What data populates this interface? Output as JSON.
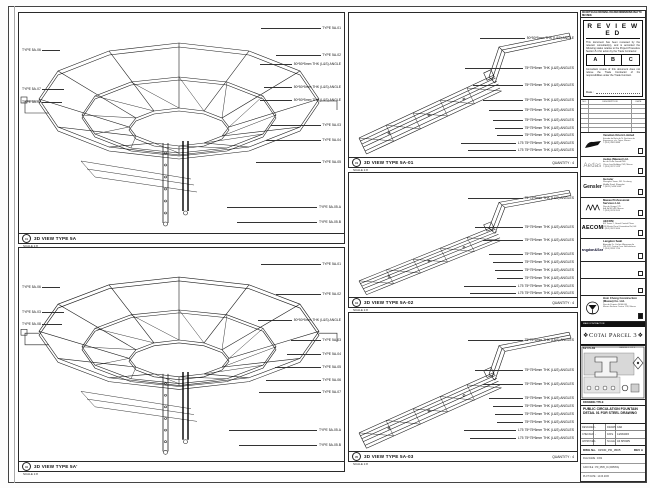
{
  "notice_line": "DO NOT SCALE DRAWING. FIGURED DIMENSIONS ONLY TO BE USED.",
  "stamp": {
    "title": "R E V I E W E D",
    "para1": "This document has been reviewed by the relevant consultant(s), and is accorded the following status relative to the Project Procedure Section 5.4 for action by the Trade Contractor.",
    "options": [
      "A",
      "B",
      "C"
    ],
    "para2": "Consultant review of this document does not relieve the Trade Contractor of his responsibilities under the Trade Contract.",
    "date_label": "Date :"
  },
  "revision_table": {
    "headers": [
      "NO.",
      "DESCRIPTION",
      "DATE"
    ]
  },
  "consultants": [
    {
      "logo_icon": "venetian-flag-logo",
      "logo_text": "Venetian",
      "name": "Venetian Orient Limited",
      "address": "Estrada da Baía de N. Senhora da\nEsperança, s/n, Taipa, Macau\nT (853) 2882 8888",
      "checked": false
    },
    {
      "logo_icon": "aedas-wordmark-logo",
      "logo_text": "Aedas",
      "name": "Aedas (Macau) Ltd.",
      "address": "Av. da Praia Grande 409\nChina Law Building 21/F, Macau\nT (853) 2871 5123",
      "checked": false
    },
    {
      "logo_icon": "gensler-wordmark-logo",
      "logo_text": "Gensler",
      "name": "Gensler",
      "address": "Shanghai Tower, 501 Yincheng\nMiddle Road, Shanghai\nT (8621) 5466 5000",
      "checked": false
    },
    {
      "logo_icon": "mps-logo",
      "logo_text": "⋀⋀⋀",
      "name": "Macau Professional\nServices Ltd.",
      "address": "Rua de Xangai 175\nEdf. ACM 14/F, Macau\nT (853) 2878 9915",
      "checked": false
    },
    {
      "logo_icon": "aecom-wordmark-logo",
      "logo_text": "AECOM",
      "name": "AECOM",
      "address": "8/F Tower 2, Grand Central Plaza\n138 Shatin Rural Committee Rd, HK\nT (852) 3922 9000",
      "checked": false
    },
    {
      "logo_icon": "langdon-seah-wordmark-logo",
      "logo_text": "Langdon&Seah",
      "name": "Langdon Seah",
      "address": "Alameda Dr. Carlos d'Assumpção\n181-187, Centro Com. Brilhantismo\nT (853) 2833 1710",
      "checked": false
    },
    {
      "logo_text": "",
      "name": "",
      "address": "",
      "checked": false
    },
    {
      "logo_text": "",
      "name": "",
      "address": "",
      "checked": false
    },
    {
      "logo_icon": "hsin-chong-circle-logo",
      "logo_text": "",
      "name": "Hsin Chong Construction\n(Macau) Co. Ltd.",
      "address": "Rua de Pequim 202A-246\nMacau Finance Centre 17/F, Macau",
      "checked": true
    }
  ],
  "main_contractor_label": "MAIN CONTRACTOR",
  "banner": {
    "project": "Cotai Parcel 3",
    "ornament": "❖"
  },
  "keyplan": {
    "caption": "KEY PLAN",
    "parcel": "PARCEL 1 OF 3"
  },
  "title_block": {
    "drawing_title_label": "DRAWING TITLE",
    "title_text": "PUBLIC CIRCULATION FOUNTAIN DETAIL 01 FOR STEEL DRAWING",
    "fields": {
      "rows": [
        {
          "l1": "DESIGNED",
          "v1": "-",
          "l2": "DRAWN",
          "v2": "CAD"
        },
        {
          "l1": "CHECKED",
          "v1": "-",
          "l2": "DATE",
          "v2": "14/03/2015"
        },
        {
          "l1": "APPROVED",
          "v1": "-",
          "l2": "SCALE",
          "v2": "AS SHOWN"
        }
      ]
    },
    "dwg": {
      "label": "DWG No.",
      "value": "01530_PD_0505",
      "rev_label": "REV",
      "rev": "A"
    },
    "footer_rows": [
      "FILE NAME : 0152",
      "CAD FILE : PD_0505_01 (R0505A)",
      "PLOT DATE : 14.03.2015"
    ]
  },
  "panels": {
    "p1": {
      "num": "01",
      "title": "3D VIEW TYPE 5A",
      "scale": "SCALE 1:8",
      "right": [
        "TYPE 5A-01",
        "TYPE 5A-02",
        "50*50*5mm THK (L&S) ANGLE",
        "50*50*5mm THK (L&S) ANGLE",
        "50*50*5mm THK (L&S) ANGLE",
        "TYPE 5A-03",
        "TYPE 5A-04",
        "TYPE 5A-05",
        "TYPE 5A-05.A",
        "TYPE 5A-05.B"
      ],
      "left": [
        "TYPE 5A-06",
        "TYPE 5A-07",
        "TYPE 5A-02"
      ]
    },
    "p2": {
      "num": "02",
      "title": "3D VIEW TYPE 5A'",
      "scale": "SCALE 1:8",
      "right": [
        "TYPE 5A-01",
        "TYPE 5A-02",
        "50*50*5mm THK (L&S) ANGLE",
        "TYPE 5A-03",
        "TYPE 5A-04",
        "TYPE 5A-05",
        "TYPE 5A-06",
        "TYPE 5A-07",
        "TYPE 5A-05.A",
        "TYPE 5A-05.B"
      ],
      "left": [
        "TYPE 5A-06",
        "TYPE 5A-03",
        "TYPE 5A-08"
      ]
    },
    "p3": {
      "num": "03",
      "title": "3D VIEW TYPE 5A-01",
      "scale": "SCALE 1:8",
      "quantity": "QUANTITY : 4",
      "labels": [
        "50*50*5mm THK (L&S) ANGLE",
        "75*75*6mm THK (L&S) ANGLES",
        "75*75*6mm THK (L&S) ANGLES",
        "75*75*6mm THK (L&S) ANGLES",
        "75*75*6mm THK (L&S) ANGLES",
        "75*75*6mm THK (L&S) ANGLES",
        "75*75*6mm THK (L&S) ANGLES",
        "75*75*6mm THK (L&S) ANGLES",
        "L75 75*75*6mm THK (L&S) ANGLES",
        "L75 75*75*6mm THK (L&S) ANGLES"
      ]
    },
    "p4": {
      "num": "04",
      "title": "3D VIEW TYPE 5A-02",
      "scale": "SCALE 1:8",
      "quantity": "QUANTITY : 4",
      "labels": [
        "75*75*6mm THK (L&S) ANGLES",
        "75*75*6mm THK (L&S) ANGLES",
        "75*75*6mm THK (L&S) ANGLES",
        "75*75*6mm THK (L&S) ANGLES",
        "75*75*6mm THK (L&S) ANGLES",
        "75*75*6mm THK (L&S) ANGLES",
        "75*75*6mm THK (L&S) ANGLES",
        "L75 75*75*6mm THK (L&S) ANGLES",
        "L75 75*75*6mm THK (L&S) ANGLES"
      ]
    },
    "p5": {
      "num": "05",
      "title": "3D VIEW TYPE 5A-03",
      "scale": "SCALE 1:8",
      "quantity": "QUANTITY : 4",
      "labels": [
        "75*75*6mm THK (L&S) ANGLES",
        "75*75*6mm THK (L&S) ANGLES",
        "75*75*6mm THK (L&S) ANGLES",
        "75*75*6mm THK (L&S) ANGLES",
        "75*75*6mm THK (L&S) ANGLES",
        "75*75*6mm THK (L&S) ANGLES",
        "75*75*6mm THK (L&S) ANGLES",
        "L75 75*75*6mm THK (L&S) ANGLES",
        "L75 75*75*6mm THK (L&S) ANGLES"
      ]
    }
  }
}
